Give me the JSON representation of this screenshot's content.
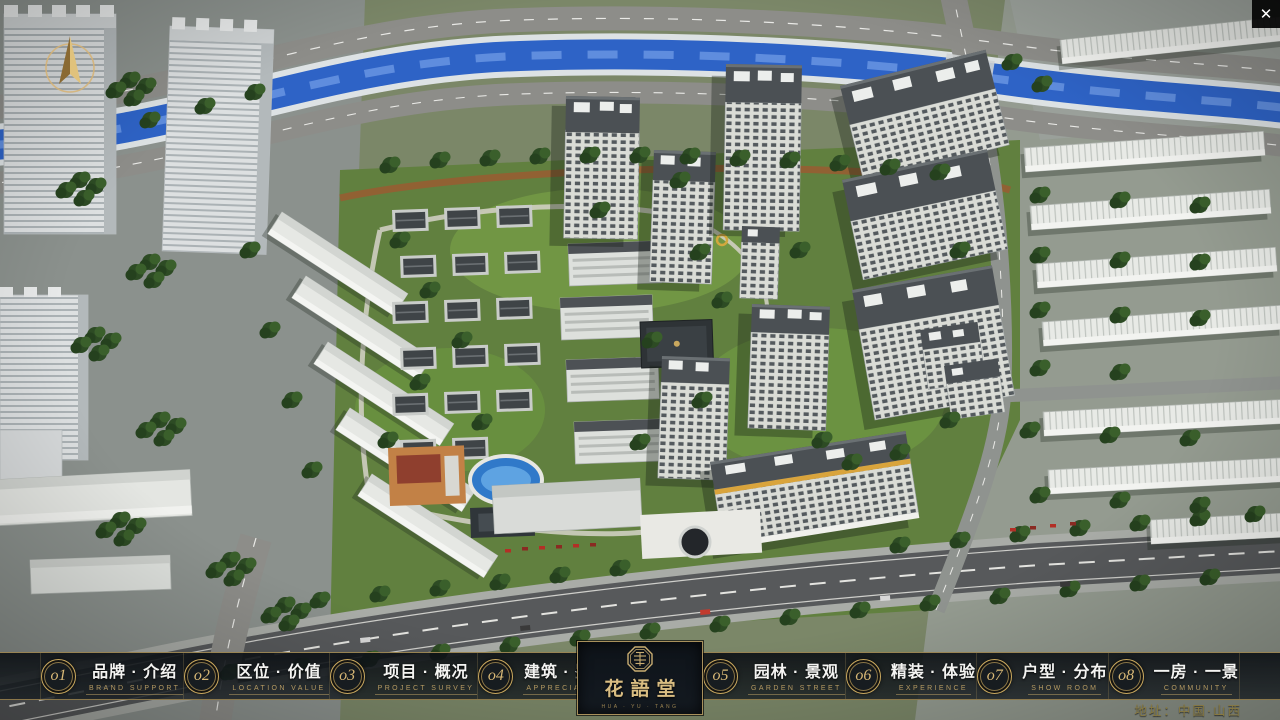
{
  "window": {
    "close_icon": "✕"
  },
  "nav": {
    "items": [
      {
        "num": "o1",
        "title": "品牌 · 介绍",
        "subtitle": "BRAND SUPPORT"
      },
      {
        "num": "o2",
        "title": "区位 · 价值",
        "subtitle": "LOCATION VALUE"
      },
      {
        "num": "o3",
        "title": "项目 · 概况",
        "subtitle": "PROJECT SURVEY"
      },
      {
        "num": "o4",
        "title": "建筑 · 鉴赏",
        "subtitle": "APPRECIATION"
      },
      {
        "num": "o5",
        "title": "园林 · 景观",
        "subtitle": "GARDEN STREET"
      },
      {
        "num": "o6",
        "title": "精装 · 体验",
        "subtitle": "EXPERIENCE"
      },
      {
        "num": "o7",
        "title": "户型 · 分布",
        "subtitle": "SHOW ROOM"
      },
      {
        "num": "o8",
        "title": "一房 · 一景",
        "subtitle": "COMMUNITY"
      }
    ]
  },
  "logo": {
    "name": "花語堂",
    "tagline": "HUA · YU · TANG"
  },
  "footer": {
    "address": "地址：中国·山西"
  },
  "colors": {
    "accent_gold": "#c9a85e",
    "panel": "#10151b",
    "river": "#2e63c6"
  }
}
